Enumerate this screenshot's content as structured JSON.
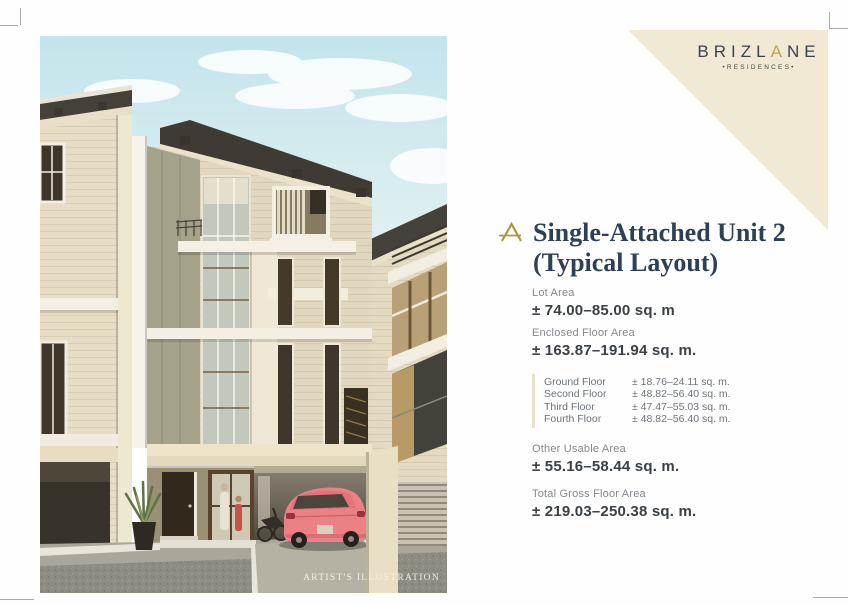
{
  "brand": {
    "name_pre": "BRIZL",
    "name_accent": "A",
    "name_post": "NE",
    "subtitle": "•RESIDENCES•",
    "accent_color": "#c2a24b"
  },
  "header": {
    "title_line1": "Single-Attached Unit 2",
    "title_line2": "(Typical Layout)"
  },
  "specs": {
    "lot_area": {
      "label": "Lot Area",
      "value": "± 74.00–85.00 sq. m"
    },
    "enclosed_floor_area": {
      "label": "Enclosed Floor Area",
      "value": "± 163.87–191.94 sq. m."
    },
    "floors": [
      {
        "label": "Ground Floor",
        "value": "± 18.76–24.11 sq. m."
      },
      {
        "label": "Second Floor",
        "value": "± 48.82–56.40 sq. m."
      },
      {
        "label": "Third Floor",
        "value": "± 47.47–55.03 sq. m."
      },
      {
        "label": "Fourth Floor",
        "value": "± 48.82–56.40 sq. m."
      }
    ],
    "other_usable_area": {
      "label": "Other Usable Area",
      "value": "± 55.16–58.44 sq. m."
    },
    "total_gross_floor_area": {
      "label": "Total Gross Floor Area",
      "value": "± 219.03–250.38 sq. m."
    }
  },
  "illustration": {
    "caption": "ARTIST'S ILLUSTRATION"
  }
}
